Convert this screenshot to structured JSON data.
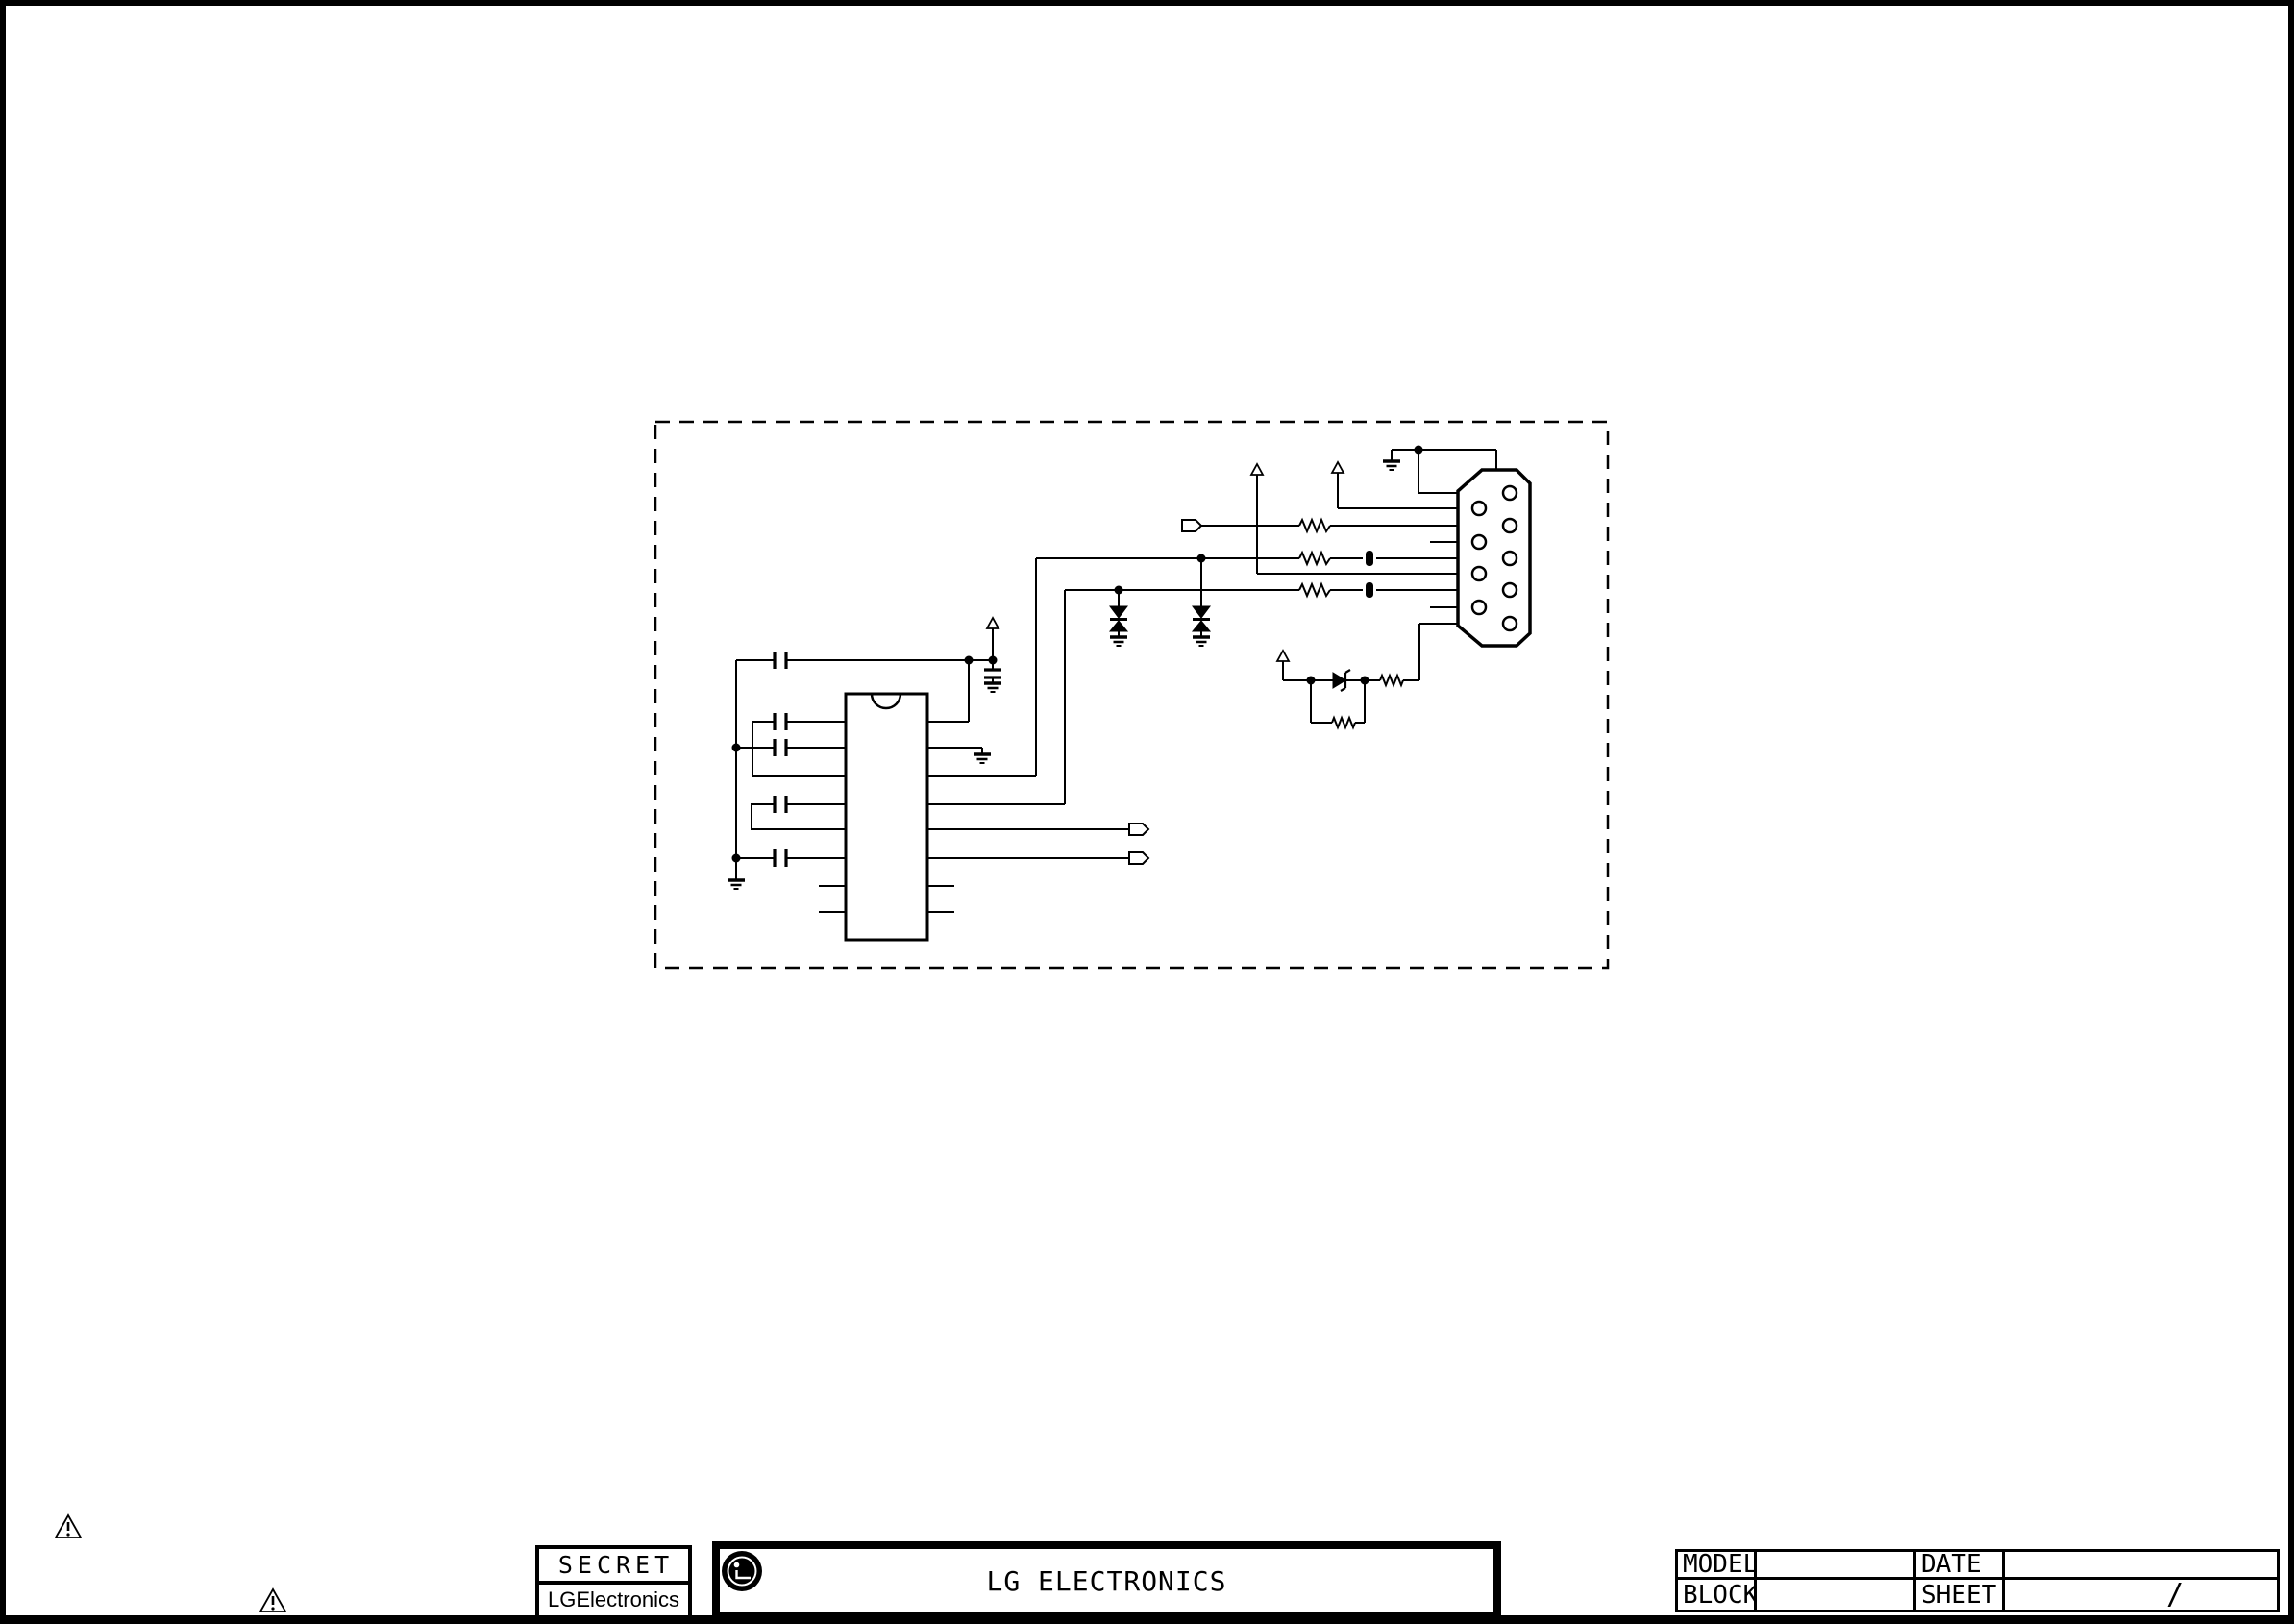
{
  "sheet": {
    "background": "#ffffff",
    "ink": "#000000"
  },
  "stamp": {
    "classification": "SECRET",
    "company": "LGElectronics"
  },
  "title_block": {
    "company": "LG ELECTRONICS"
  },
  "info_table": {
    "model_label": "MODEL",
    "model_value": "",
    "date_label": "DATE",
    "date_value": "",
    "block_label": "BLOCK",
    "block_value": "",
    "sheet_label": "SHEET",
    "sheet_value": "/"
  },
  "schematic": {
    "kind": "circuit-schematic",
    "boundary": "dashed-rectangle",
    "ic": {
      "package": "DIP-16",
      "pins_per_side": 8
    },
    "connector": {
      "type": "D-SUB 9-pin",
      "pins": 9
    },
    "component_counts": {
      "capacitors": 6,
      "resistors": 5,
      "bidirectional_tvs_diodes": 2,
      "zener_diodes": 1,
      "ferrite_beads": 2,
      "ground_symbols": 6,
      "power_taps": 4,
      "net_tags": 3,
      "junction_dots": 9
    },
    "caution_markers": 2
  }
}
